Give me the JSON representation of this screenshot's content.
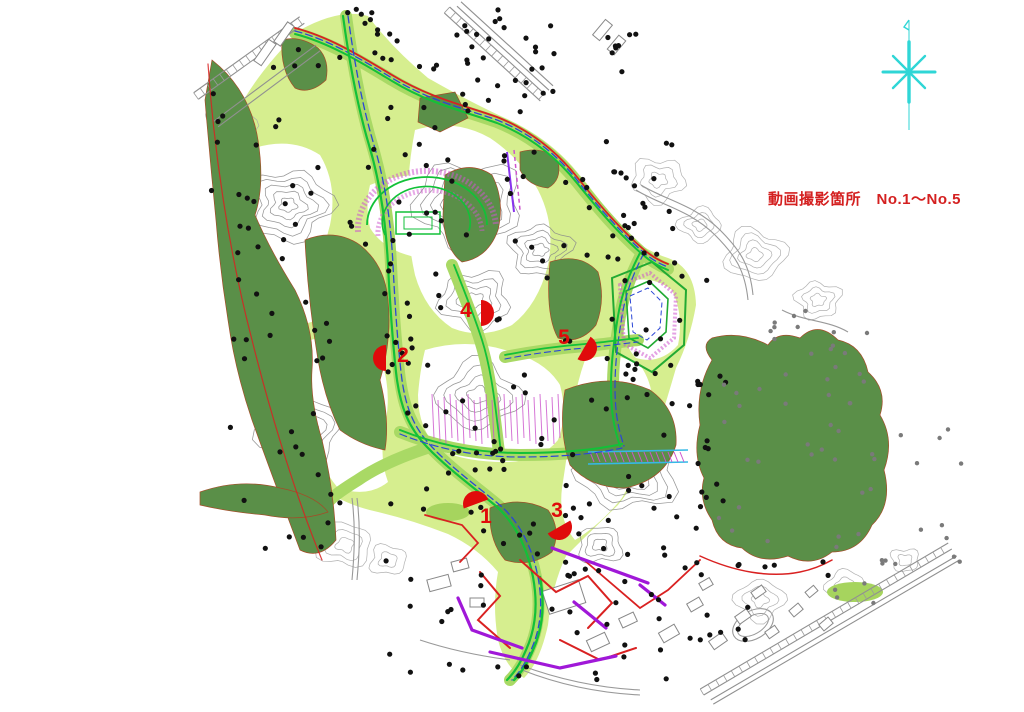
{
  "title": {
    "text": "動画撮影箇所　No.1～No.5",
    "color": "#d42020"
  },
  "markers": {
    "color": "#e00b0b",
    "items": [
      {
        "label": "1",
        "x": 486,
        "y": 517,
        "fan": {
          "x": 476,
          "y": 504,
          "angle": -20
        }
      },
      {
        "label": "2",
        "x": 403,
        "y": 356,
        "fan": {
          "x": 386,
          "y": 358,
          "angle": -90
        }
      },
      {
        "label": "3",
        "x": 557,
        "y": 511,
        "fan": {
          "x": 559,
          "y": 527,
          "angle": 150
        }
      },
      {
        "label": "4",
        "x": 466,
        "y": 311,
        "fan": {
          "x": 481,
          "y": 313,
          "angle": 90
        }
      },
      {
        "label": "5",
        "x": 564,
        "y": 338,
        "fan": {
          "x": 584,
          "y": 348,
          "angle": 120
        }
      }
    ]
  },
  "compass": {
    "icon": "north-star",
    "color": "#2fd6d6"
  },
  "palette": {
    "site_light_green": "#d6ee8f",
    "road_band_green": "#a9d965",
    "forest_dark_green": "#5a8f48",
    "route_bright_green": "#12c138",
    "route_blue": "#2b46d6",
    "boundary_red": "#d92121",
    "hatch_magenta": "#cd55cd",
    "utility_purple": "#a018d8",
    "channel_cyan": "#35b9e6",
    "contour_gray": "#8c8c8c"
  }
}
